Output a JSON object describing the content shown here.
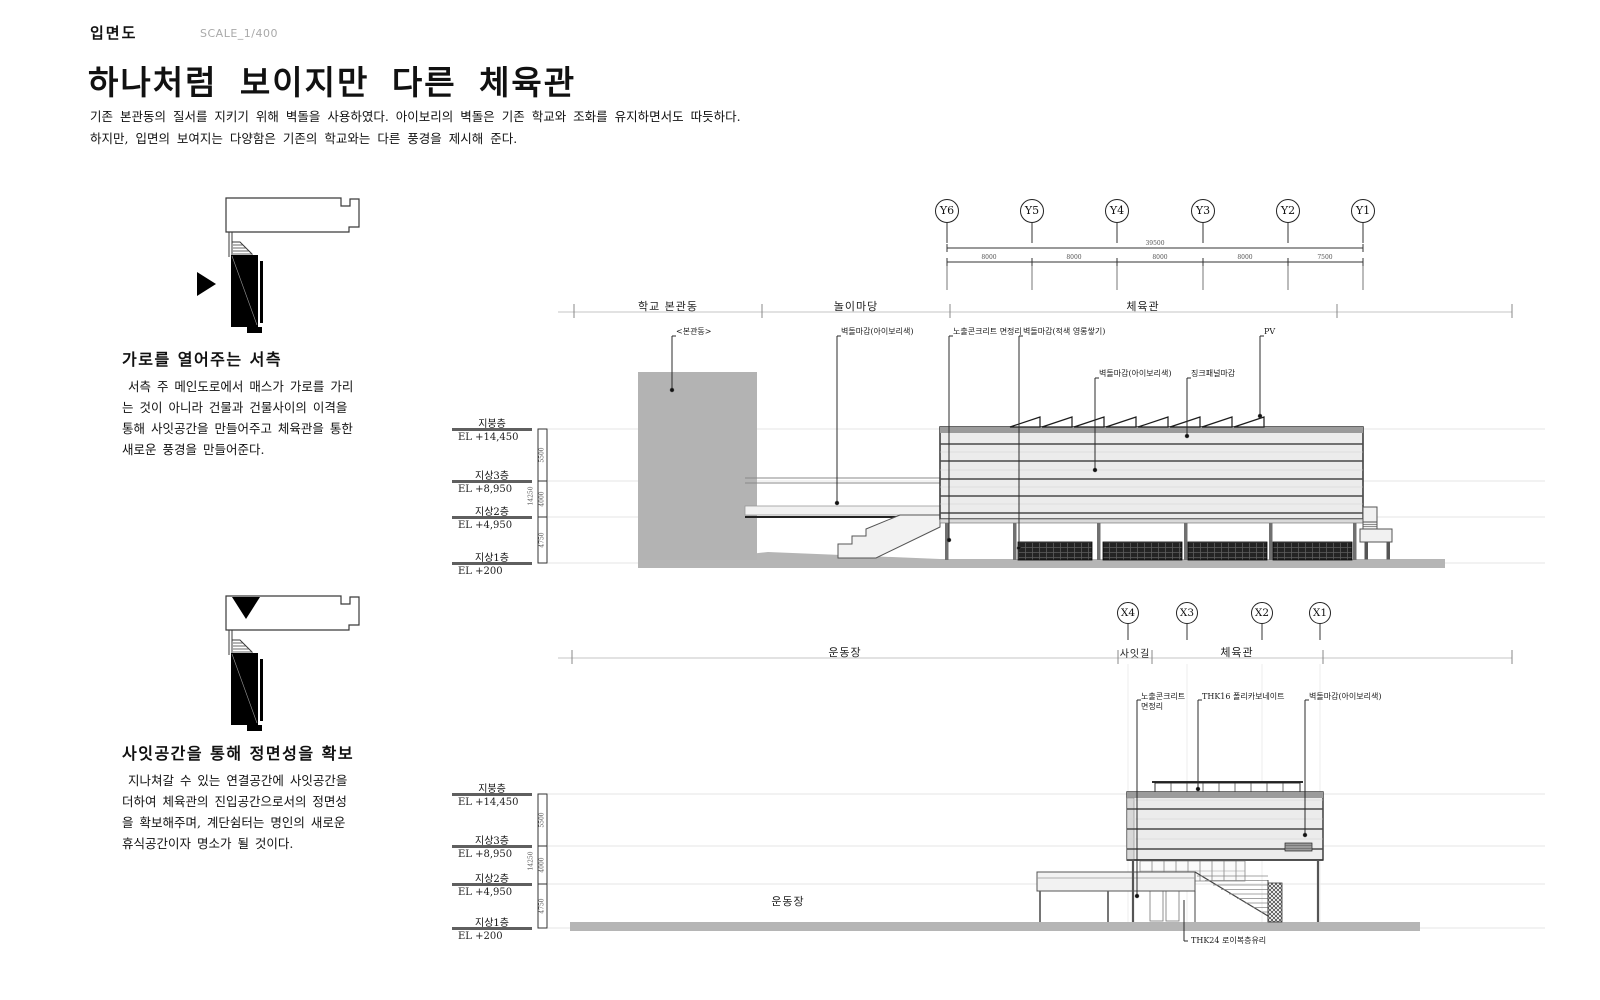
{
  "header": {
    "doc_type": "입면도",
    "scale": "SCALE_1/400",
    "title": "하나처럼 보이지만 다른 체육관",
    "intro1": "기존 본관동의 질서를 지키기 위해 벽돌을 사용하였다. 아이보리의 벽돌은 기존 학교와 조화를 유지하면서도 따듯하다.",
    "intro2": "하지만, 입면의 보여지는 다양함은 기존의 학교와는 다른 풍경을 제시해 준다."
  },
  "west_diagram": {
    "caption": "가로를 열어주는 서측",
    "lines": [
      " 서측 주 메인도로에서 매스가 가로를 가리",
      "는 것이 아니라 건물과 건물사이의 이격을",
      "통해 사잇공간을 만들어주고 체육관을 통한",
      "새로운 풍경을 만들어준다."
    ]
  },
  "front_diagram": {
    "caption": "사잇공간을 통해 정면성을 확보",
    "lines": [
      " 지나쳐갈 수 있는 연결공간에 사잇공간을",
      "더하여 체육관의 진입공간으로서의 정면성",
      "을 확보해주며, 계단쉼터는 명인의 새로운",
      "휴식공간이자 명소가 될 것이다."
    ]
  },
  "levels": [
    {
      "name": "지붕층",
      "el": "EL +14,450"
    },
    {
      "name": "지상3층",
      "el": "EL +8,950"
    },
    {
      "name": "지상2층",
      "el": "EL +4,950"
    },
    {
      "name": "지상1층",
      "el": "EL +200"
    }
  ],
  "vertical_dims": {
    "total": "14250",
    "segments": [
      "5500",
      "4000",
      "4750"
    ]
  },
  "upper_elevation": {
    "grid": [
      "Y6",
      "Y5",
      "Y4",
      "Y3",
      "Y2",
      "Y1"
    ],
    "dim_total": "39500",
    "dim_segments": [
      "8000",
      "8000",
      "8000",
      "8000",
      "7500"
    ],
    "zones": [
      "학교 본관동",
      "놀이마당",
      "체육관"
    ],
    "labels": [
      "<본관동>",
      "벽돌마감(아이보리색)",
      "노출콘크리트 면정리",
      "벽돌마감(적색 영롱쌓기)",
      "벽돌마감(아이보리색)",
      "징크패널마감",
      "PV"
    ]
  },
  "lower_elevation": {
    "grid": [
      "X4",
      "X3",
      "X2",
      "X1"
    ],
    "zones": [
      "운동장",
      "사잇길",
      "체육관"
    ],
    "labels": [
      [
        "노출콘크리트",
        "면정리"
      ],
      [
        "THK16 폴리카보네이트"
      ],
      [
        "벽돌마감(아이보리색)"
      ]
    ],
    "ground_label": "운동장",
    "bottom_label": "THK24 로이복층유리"
  }
}
